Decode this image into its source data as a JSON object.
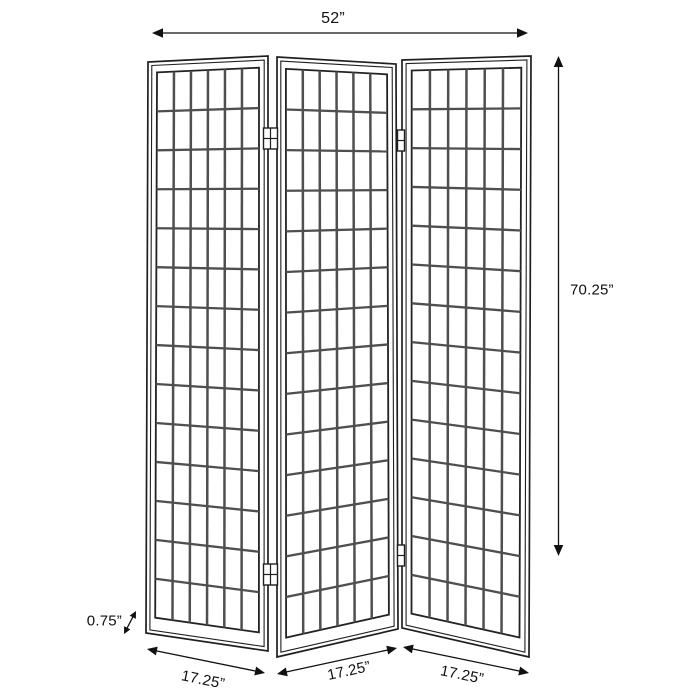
{
  "figure": {
    "description": "Dimension diagram of a three-panel shoji-style folding screen room divider",
    "units": "inches",
    "dimensions": {
      "total_width_label": "52”",
      "height_label": "70.25”",
      "thickness_label": "0.75”",
      "panel_width_labels": [
        "17.25”",
        "17.25”",
        "17.25”"
      ],
      "total_width_in": 52,
      "height_in": 70.25,
      "thickness_in": 0.75,
      "panel_width_in": 17.25,
      "panel_count": 3
    },
    "colors": {
      "background": "#ffffff",
      "frame": "#1f1f1f",
      "grid": "#4f4f4f",
      "dimension": "#111111",
      "text": "#111111"
    },
    "panels": [
      {
        "name": "left-panel",
        "grid_cols": 6,
        "grid_rows": 14,
        "quad": {
          "tl": [
            148,
            62
          ],
          "tr": [
            268,
            56
          ],
          "br": [
            268,
            651
          ],
          "bl": [
            146,
            633
          ]
        }
      },
      {
        "name": "middle-panel",
        "grid_cols": 6,
        "grid_rows": 14,
        "quad": {
          "tl": [
            277,
            57
          ],
          "tr": [
            396,
            64
          ],
          "br": [
            398,
            629
          ],
          "bl": [
            277,
            657
          ]
        }
      },
      {
        "name": "right-panel",
        "grid_cols": 6,
        "grid_rows": 14,
        "quad": {
          "tl": [
            402,
            60
          ],
          "tr": [
            531,
            56
          ],
          "br": [
            529,
            657
          ],
          "bl": [
            402,
            628
          ]
        }
      }
    ],
    "hinges": [
      {
        "name": "hinge-left-top",
        "x": 263.5,
        "y": 128,
        "w": 14,
        "h": 21
      },
      {
        "name": "hinge-left-bottom",
        "x": 263.5,
        "y": 564,
        "w": 14,
        "h": 21
      },
      {
        "name": "hinge-right-top",
        "x": 397.5,
        "y": 130,
        "w": 7,
        "h": 21
      },
      {
        "name": "hinge-right-bottom",
        "x": 397.5,
        "y": 545,
        "w": 7,
        "h": 21
      }
    ],
    "dimension_arrows": [
      {
        "name": "width-arrow",
        "x1": 152,
        "y1": 33,
        "x2": 528,
        "y2": 33,
        "head": 11
      },
      {
        "name": "height-arrow",
        "x1": 558.5,
        "y1": 56,
        "x2": 558.5,
        "y2": 556,
        "head": 11
      },
      {
        "name": "thickness-arrow",
        "x1": 136,
        "y1": 611,
        "x2": 124,
        "y2": 634,
        "head": 7
      },
      {
        "name": "panel1-width-arrow",
        "x1": 147,
        "y1": 649,
        "x2": 265,
        "y2": 673,
        "head": 10
      },
      {
        "name": "panel2-width-arrow",
        "x1": 277,
        "y1": 674,
        "x2": 397,
        "y2": 648,
        "head": 10
      },
      {
        "name": "panel3-width-arrow",
        "x1": 403,
        "y1": 647,
        "x2": 529,
        "y2": 673,
        "head": 10
      }
    ]
  }
}
